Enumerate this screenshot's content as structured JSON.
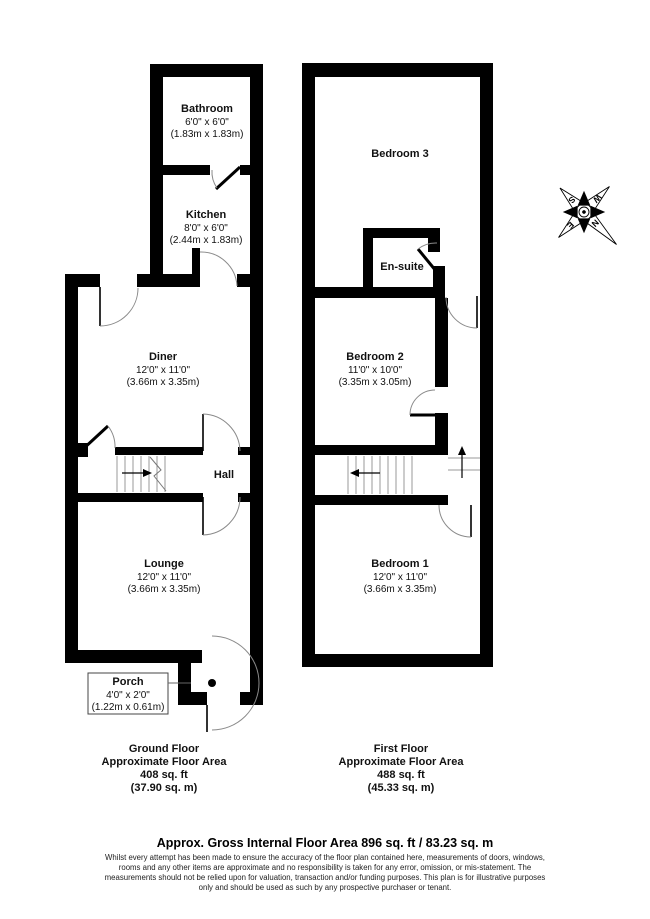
{
  "ground_floor": {
    "rooms": {
      "bathroom": {
        "name": "Bathroom",
        "dim_ft": "6'0\" x 6'0\"",
        "dim_m": "(1.83m x 1.83m)"
      },
      "kitchen": {
        "name": "Kitchen",
        "dim_ft": "8'0\" x 6'0\"",
        "dim_m": "(2.44m x 1.83m)"
      },
      "diner": {
        "name": "Diner",
        "dim_ft": "12'0\" x 11'0\"",
        "dim_m": "(3.66m x 3.35m)"
      },
      "hall": {
        "name": "Hall"
      },
      "lounge": {
        "name": "Lounge",
        "dim_ft": "12'0\" x 11'0\"",
        "dim_m": "(3.66m x 3.35m)"
      },
      "porch": {
        "name": "Porch",
        "dim_ft": "4'0\" x 2'0\"",
        "dim_m": "(1.22m x 0.61m)"
      }
    },
    "caption": {
      "line1": "Ground Floor",
      "line2": "Approximate Floor Area",
      "line3": "408 sq. ft",
      "line4": "(37.90 sq. m)"
    }
  },
  "first_floor": {
    "rooms": {
      "bedroom3": {
        "name": "Bedroom 3"
      },
      "ensuite": {
        "name": "En-suite"
      },
      "bedroom2": {
        "name": "Bedroom 2",
        "dim_ft": "11'0\" x 10'0\"",
        "dim_m": "(3.35m x 3.05m)"
      },
      "bedroom1": {
        "name": "Bedroom 1",
        "dim_ft": "12'0\" x 11'0\"",
        "dim_m": "(3.66m x 3.35m)"
      }
    },
    "caption": {
      "line1": "First Floor",
      "line2": "Approximate Floor Area",
      "line3": "488 sq. ft",
      "line4": "(45.33 sq. m)"
    }
  },
  "compass": {
    "n": "N",
    "e": "E",
    "s": "S",
    "w": "W"
  },
  "footer": {
    "title": "Approx. Gross Internal Floor Area 896 sq. ft / 83.23 sq. m",
    "disclaimer_lines": [
      "Whilst every attempt has been made to ensure the accuracy of the floor plan contained here, measurements of doors, windows,",
      "rooms and any other items are approximate and no responsibility is taken for any error, omission, or mis-statement. The",
      "measurements should not be relied upon for valuation, transaction and/or funding purposes. This plan is for illustrative purposes",
      "only and should be used as such by any prospective purchaser or tenant."
    ]
  },
  "colors": {
    "wall": "#000000",
    "door_arc": "#8a8a8a",
    "background": "#ffffff"
  }
}
